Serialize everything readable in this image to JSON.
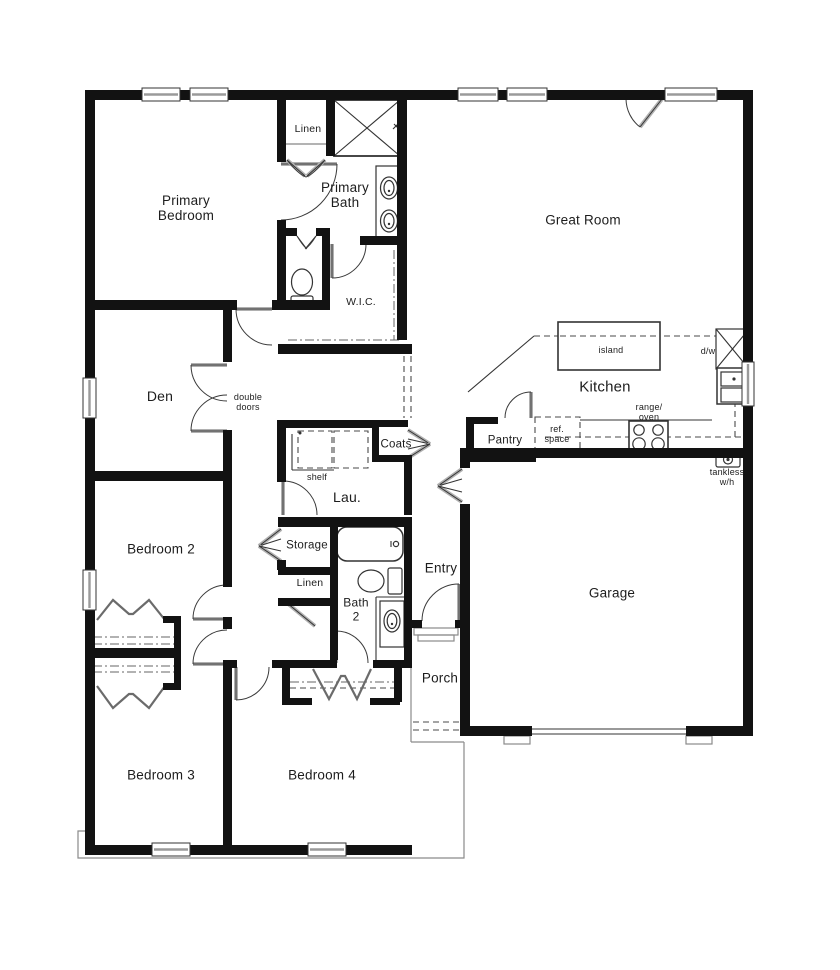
{
  "meta": {
    "type": "residential floor plan",
    "view": "top-down architectural drawing"
  },
  "colors": {
    "wall": "#121212",
    "line": "#333333",
    "door_leaf": "#b0b0b0",
    "dashed": "#4a4a4a",
    "background": "#ffffff"
  },
  "labels": {
    "primary_bedroom": "Primary\nBedroom",
    "linen_top": "Linen",
    "primary_bath": "Primary\nBath",
    "wic": "W.I.C.",
    "great_room": "Great Room",
    "den": "Den",
    "double_doors": "double\ndoors",
    "kitchen": "Kitchen",
    "island": "island",
    "dw": "d/w",
    "pantry": "Pantry",
    "ref_space": "ref.\nspace",
    "range_oven": "range/\noven",
    "tankless": "tankless\nw/h",
    "coats": "Coats",
    "laundry": "Lau.",
    "shelf": "shelf",
    "storage": "Storage",
    "linen_hall": "Linen",
    "bath2": "Bath\n2",
    "entry": "Entry",
    "porch": "Porch",
    "garage": "Garage",
    "bedroom2": "Bedroom 2",
    "bedroom3": "Bedroom 3",
    "bedroom4": "Bedroom 4"
  }
}
